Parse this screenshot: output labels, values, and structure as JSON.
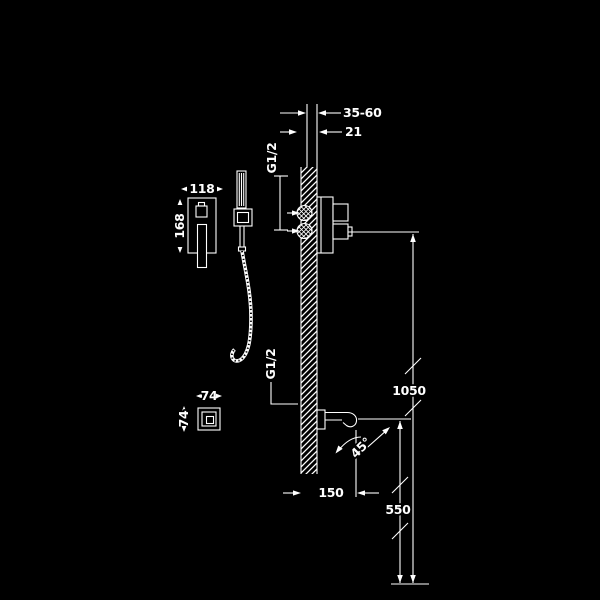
{
  "diagram": {
    "colors": {
      "background": "#000000",
      "line": "#ffffff"
    },
    "labels": {
      "install_depth_range": "35-60",
      "install_depth_offset": "21",
      "top_connection_thread": "G1/2",
      "plate_width": "118",
      "plate_height": "168",
      "mixer_height": "1050",
      "outlet_height": "550",
      "outlet_projection": "150",
      "outlet_plate_width": "74",
      "outlet_plate_height": "74",
      "bottom_connection_thread": "G1/2",
      "swivel_angle": "45°"
    }
  }
}
